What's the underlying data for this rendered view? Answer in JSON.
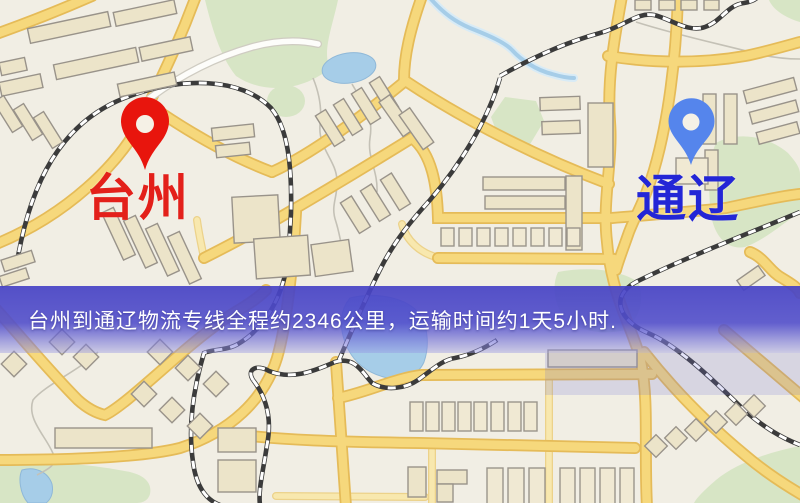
{
  "banner": {
    "text": "台州到通辽物流专线全程约2346公里，运输时间约1天5小时.",
    "bg_color": "#524fc9",
    "text_color": "#ffffff"
  },
  "markers": {
    "origin": {
      "label": "台州",
      "pin_color": "#e8150d",
      "hole_color": "#f5f1e6",
      "label_color": "#e3201a"
    },
    "destination": {
      "label": "通辽",
      "pin_color": "#5585ec",
      "hole_color": "#f5f1e6",
      "label_color": "#2326d6"
    }
  },
  "route": {
    "origin_city": "台州",
    "destination_city": "通辽",
    "distance_km": "2346",
    "duration": "1天5小时"
  },
  "palette": {
    "map_background": "#f1eee4",
    "road_fill": "#f6d87c",
    "road_border": "#e5bb58",
    "park_green": "#d7e5c5",
    "water_blue": "#a6cde8",
    "building_fill": "#ece4c9",
    "railway_dark": "#3b3b3b"
  }
}
